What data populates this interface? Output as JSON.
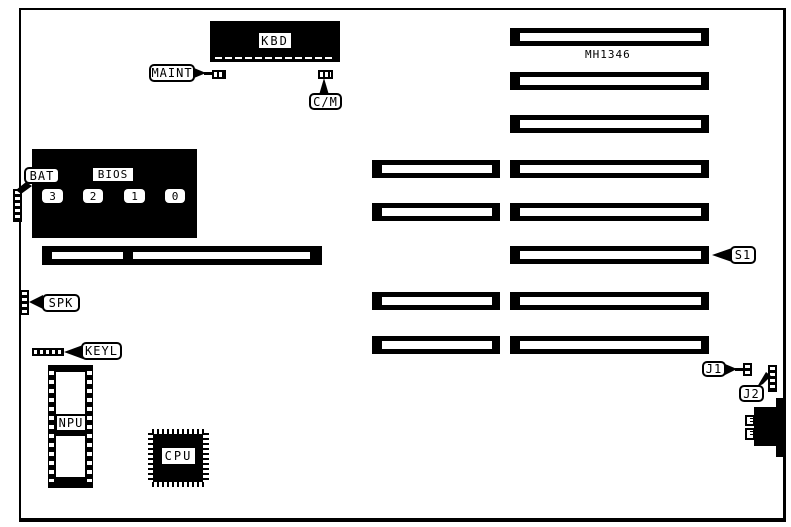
{
  "diagram": {
    "board_model": "MH1346",
    "colors": {
      "ink": "#000000",
      "paper": "#ffffff"
    },
    "slot_counts": {
      "long_slots": 8,
      "short_slots": 4
    },
    "components": {
      "kbd": {
        "label": "KBD"
      },
      "maint": {
        "label": "MAINT"
      },
      "cm": {
        "label": "C/M"
      },
      "bat": {
        "label": "BAT"
      },
      "bios": {
        "label": "BIOS",
        "chips": [
          "3",
          "2",
          "1",
          "0"
        ]
      },
      "spk": {
        "label": "SPK"
      },
      "keyl": {
        "label": "KEYL"
      },
      "npu": {
        "label": "NPU"
      },
      "cpu": {
        "label": "CPU"
      },
      "s1": {
        "label": "S1"
      },
      "j1": {
        "label": "J1"
      },
      "j2": {
        "label": "J2"
      }
    }
  }
}
